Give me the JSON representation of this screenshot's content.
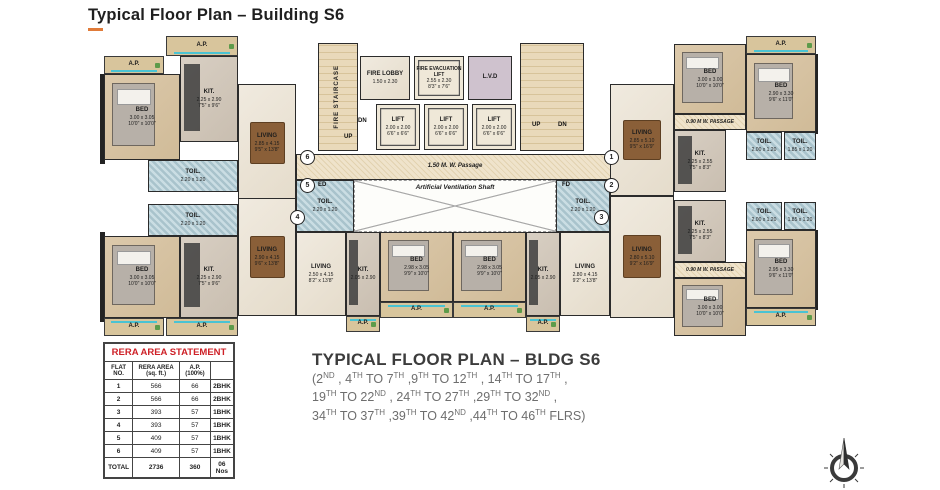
{
  "page": {
    "title": "Typical Floor Plan – Building S6"
  },
  "plan": {
    "core": {
      "fire_staircase": "FIRE STAIRCASE",
      "up": "UP",
      "dn": "DN",
      "fire_lobby": {
        "label": "FIRE LOBBY",
        "dim_m": "1.50 x 2.30"
      },
      "evac_lift": {
        "label": "FIRE EVACUATION LIFT",
        "dim_m": "2.55 x 2.30",
        "dim_ft": "8'3\" x 7'6\""
      },
      "lvd": "L.V.D",
      "lift": {
        "label": "LIFT",
        "dim_m": "2.00 x 2.00",
        "dim_ft": "6'6\" x 6'6\""
      },
      "main_passage": "1.50 M. W. Passage",
      "vent_shaft": "Artificial Ventilation Shaft",
      "side_passage": "0.90 M W. PASSAGE",
      "ed": "ED",
      "fd": "FD",
      "ap": "A.P."
    },
    "flats": [
      "1",
      "2",
      "3",
      "4",
      "5",
      "6"
    ],
    "rooms": [
      {
        "label": "BED",
        "dim_m": "3.00 x 3.05",
        "dim_ft": "10'0\" x 10'0\""
      },
      {
        "label": "KIT.",
        "dim_m": "2.25 x 2.90",
        "dim_ft": "7'5\" x 9'6\""
      },
      {
        "label": "LIVING",
        "dim_m": "2.85 x 4.15",
        "dim_ft": "9'5\" x 13'8\""
      },
      {
        "label": "TOIL.",
        "dim_m": "2.20 x 1.20",
        "dim_ft": "7'3\" x 4'0\""
      },
      {
        "label": "BED",
        "dim_m": "3.00 x 3.05",
        "dim_ft": "10'0\" x 10'0\""
      },
      {
        "label": "KIT.",
        "dim_m": "2.25 x 2.90",
        "dim_ft": "7'5\" x 9'6\""
      },
      {
        "label": "LIVING",
        "dim_m": "2.90 x 4.15",
        "dim_ft": "9'6\" x 13'8\""
      },
      {
        "label": "TOIL.",
        "dim_m": "2.20 x 1.20",
        "dim_ft": "7'3\" x 4'0\""
      },
      {
        "label": "LIVING",
        "dim_m": "2.50 x 4.15",
        "dim_ft": "8'2\" x 13'8\""
      },
      {
        "label": "KIT.",
        "dim_m": "2.05 x 2.90",
        "dim_ft": "6'9\" x 9'6\""
      },
      {
        "label": "BED",
        "dim_m": "2.98 x 3.05",
        "dim_ft": "9'9\" x 10'0\""
      },
      {
        "label": "TOIL.",
        "dim_m": "2.20 x 1.20",
        "dim_ft": "7'3\" x 4'0\""
      },
      {
        "label": "BED",
        "dim_m": "2.98 x 3.05",
        "dim_ft": "9'9\" x 10'0\""
      },
      {
        "label": "KIT.",
        "dim_m": "2.05 x 2.90",
        "dim_ft": "6'9\" x 9'6\""
      },
      {
        "label": "LIVING",
        "dim_m": "2.80 x 4.15",
        "dim_ft": "9'2\" x 13'8\""
      },
      {
        "label": "TOIL.",
        "dim_m": "2.20 x 1.20",
        "dim_ft": "7'3\" x 4'0\""
      },
      {
        "label": "LIVING",
        "dim_m": "2.85 x 5.10",
        "dim_ft": "9'5\" x 16'9\""
      },
      {
        "label": "BED",
        "dim_m": "3.00 x 3.00",
        "dim_ft": "10'0\" x 10'0\""
      },
      {
        "label": "BED",
        "dim_m": "2.90 x 3.30",
        "dim_ft": "9'6\" x 11'0\""
      },
      {
        "label": "KIT.",
        "dim_m": "2.25 x 2.55",
        "dim_ft": "7'5\" x 8'3\""
      },
      {
        "label": "TOIL.",
        "dim_m": "2.00 x 1.20",
        "dim_ft": "6'6\" x 4'0\""
      },
      {
        "label": "TOIL.",
        "dim_m": "1.85 x 1.20",
        "dim_ft": "6'0\" x 4'0\""
      },
      {
        "label": "LIVING",
        "dim_m": "2.80 x 5.10",
        "dim_ft": "9'2\" x 16'9\""
      },
      {
        "label": "BED",
        "dim_m": "3.00 x 3.00",
        "dim_ft": "10'0\" x 10'0\""
      },
      {
        "label": "BED",
        "dim_m": "2.95 x 3.30",
        "dim_ft": "9'6\" x 11'0\""
      },
      {
        "label": "KIT.",
        "dim_m": "2.25 x 2.55",
        "dim_ft": "7'5\" x 8'3\""
      },
      {
        "label": "TOIL.",
        "dim_m": "2.00 x 1.20",
        "dim_ft": "6'6\" x 4'0\""
      },
      {
        "label": "TOIL.",
        "dim_m": "1.85 x 1.20",
        "dim_ft": "6'0\" x 4'0\""
      }
    ]
  },
  "rera_table": {
    "title": "RERA AREA STATEMENT",
    "headers": [
      "FLAT NO.",
      "RERA AREA (sq. ft.)",
      "A.P. (100%)",
      ""
    ],
    "rows": [
      [
        "1",
        "566",
        "66",
        "2BHK"
      ],
      [
        "2",
        "566",
        "66",
        "2BHK"
      ],
      [
        "3",
        "393",
        "57",
        "1BHK"
      ],
      [
        "4",
        "393",
        "57",
        "1BHK"
      ],
      [
        "5",
        "409",
        "57",
        "1BHK"
      ],
      [
        "6",
        "409",
        "57",
        "1BHK"
      ]
    ],
    "total": [
      "TOTAL",
      "2736",
      "360",
      "06 Nos"
    ]
  },
  "caption": {
    "title": "TYPICAL FLOOR PLAN – BLDG S6",
    "lines": [
      "(2ND , 4TH TO 7TH ,9TH TO 12TH , 14TH TO 17TH ,",
      "19TH TO 22ND ,  24TH TO 27TH ,29TH TO 32ND ,",
      "34TH TO 37TH ,39TH TO 42ND ,44TH TO 46TH FLRS)"
    ]
  }
}
